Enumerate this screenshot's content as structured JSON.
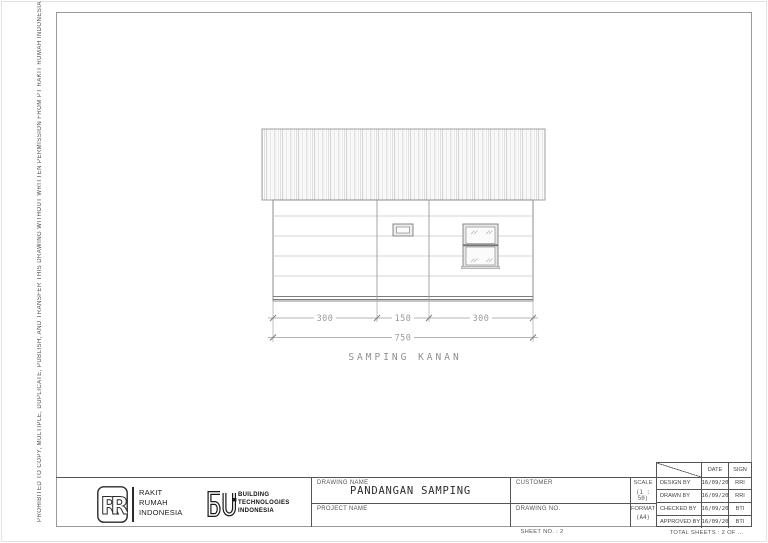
{
  "page": {
    "side_note": "PROHIBITED TO COPY, MULTIPLE, DUPLICATE, PUBLISH, AND TRANSFER THIS DRAWING WITHOUT WRITTEN PERMISSION FROM PT RAKIT RUMAH INDONESIA",
    "sheet_no": "SHEET NO. : 2",
    "total_sheets": "TOTAL SHEETS : 2 OF ..."
  },
  "drawing": {
    "view_title": "SAMPING KANAN",
    "dim_a": "300",
    "dim_b": "150",
    "dim_c": "300",
    "dim_total": "750"
  },
  "title_block": {
    "rakit_rumah": {
      "letters": [
        "R",
        "R"
      ],
      "lines": [
        "RAKIT",
        "RUMAH",
        "INDONESIA"
      ]
    },
    "building_tech": {
      "lines": [
        "BUILDING",
        "TECHNOLOGIES",
        "INDONESIA"
      ]
    },
    "drawing_name_label": "DRAWING NAME",
    "drawing_name_value": "PANDANGAN SAMPING",
    "project_name_label": "PROJECT NAME",
    "customer_label": "CUSTOMER",
    "drawing_no_label": "DRAWING NO.",
    "scale_label": "SCALE",
    "scale_value": "(1 : 50)",
    "format_label": "FORMAT",
    "format_value": "(A4)",
    "approval": {
      "date_header": "DATE",
      "sign_header": "SIGN",
      "rows": [
        {
          "label": "DESIGN BY",
          "date": "16/09/20",
          "sign": "RRI"
        },
        {
          "label": "DRAWN BY",
          "date": "16/09/20",
          "sign": "RRI"
        },
        {
          "label": "CHECKED BY",
          "date": "16/09/20",
          "sign": "BTI"
        },
        {
          "label": "APPROVED BY",
          "date": "16/09/20",
          "sign": "BTI"
        }
      ]
    }
  },
  "colors": {
    "line_dark": "#555555",
    "line_light": "#aaaaaa",
    "dim_text": "#9a9a9a",
    "ink": "#2b2b2b"
  }
}
